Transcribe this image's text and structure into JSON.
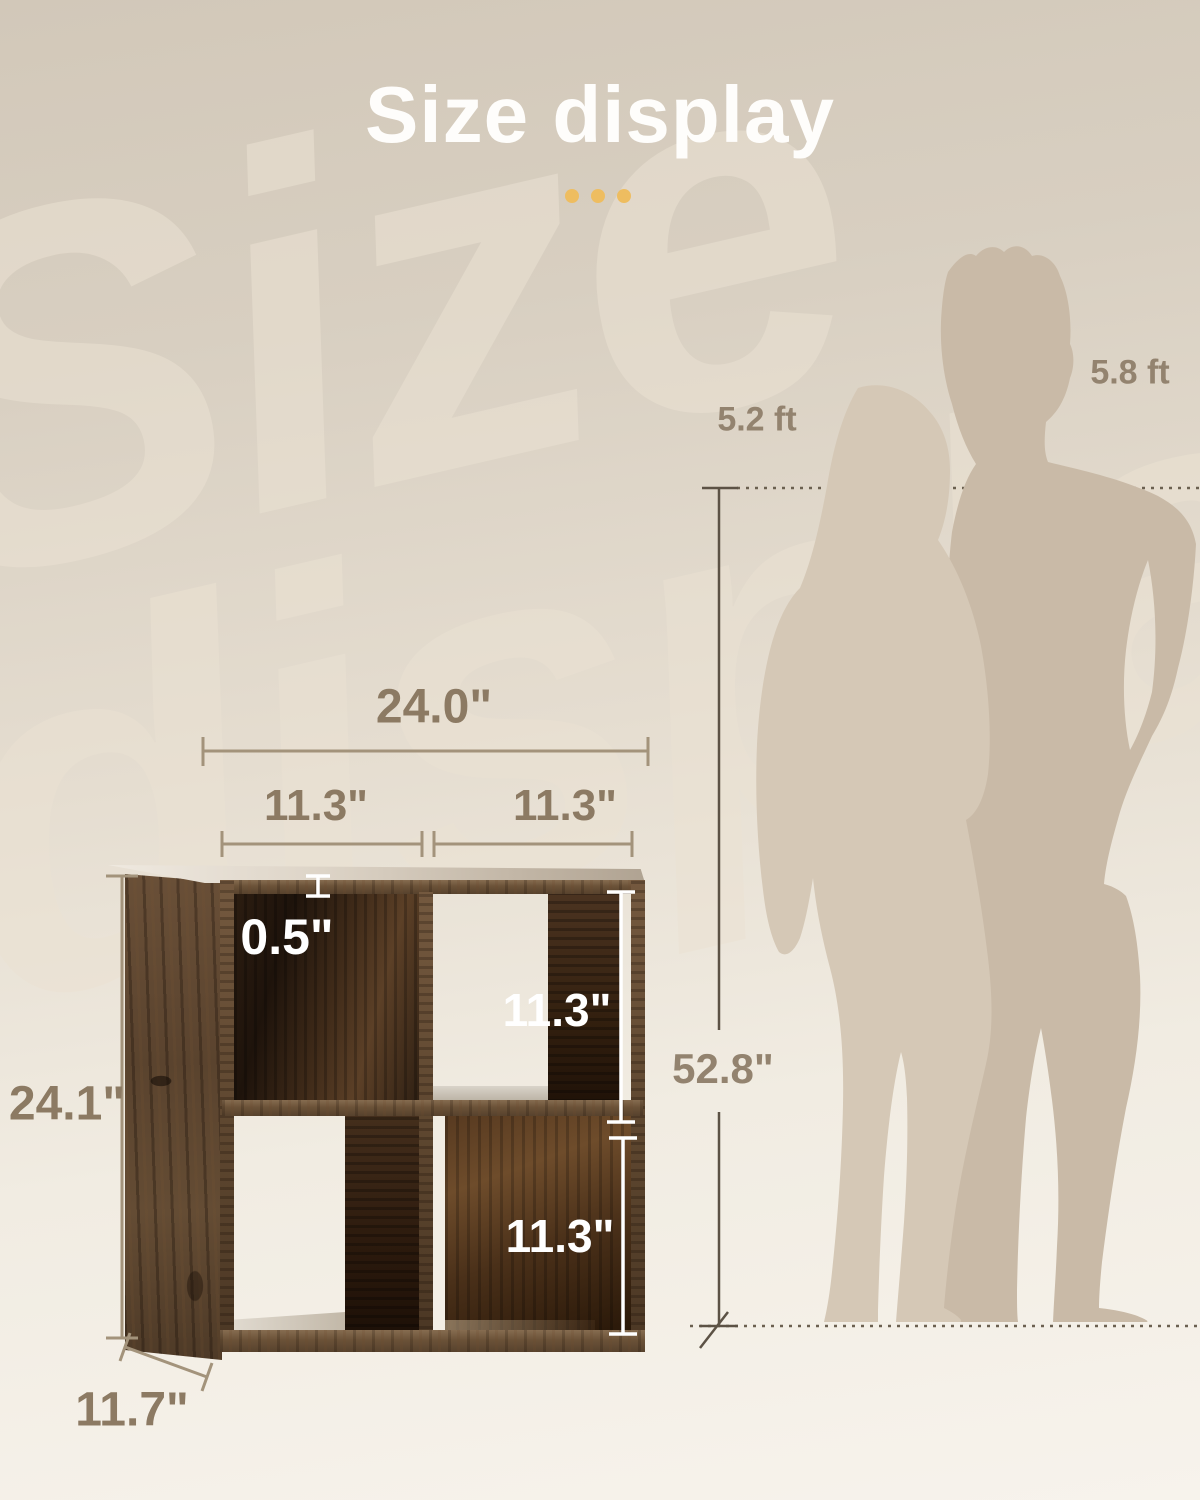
{
  "title": "Size display",
  "watermark": {
    "line1": "Size",
    "line2": "display"
  },
  "shelf_dims": {
    "total_width": "24.0\"",
    "left_cube_width": "11.3\"",
    "right_cube_width": "11.3\"",
    "panel_thickness": "0.5\"",
    "top_cube_height": "11.3\"",
    "bottom_cube_height": "11.3\"",
    "total_height": "24.1\"",
    "depth": "11.7\""
  },
  "scene": {
    "reference_height": "52.8\"",
    "woman_height": "5.2 ft",
    "man_height": "5.8 ft"
  },
  "colors": {
    "accent_gold": "#eebd60",
    "dimension_text": "#8c7a63",
    "dimension_line": "#a3937b",
    "reference_line": "#5c5245",
    "white_annotation": "#ffffff",
    "silhouette_woman": "#d5c8b6",
    "silhouette_man": "#c9baa7",
    "background_top": "#d2c8b9",
    "background_bottom": "#f7f3ec"
  }
}
